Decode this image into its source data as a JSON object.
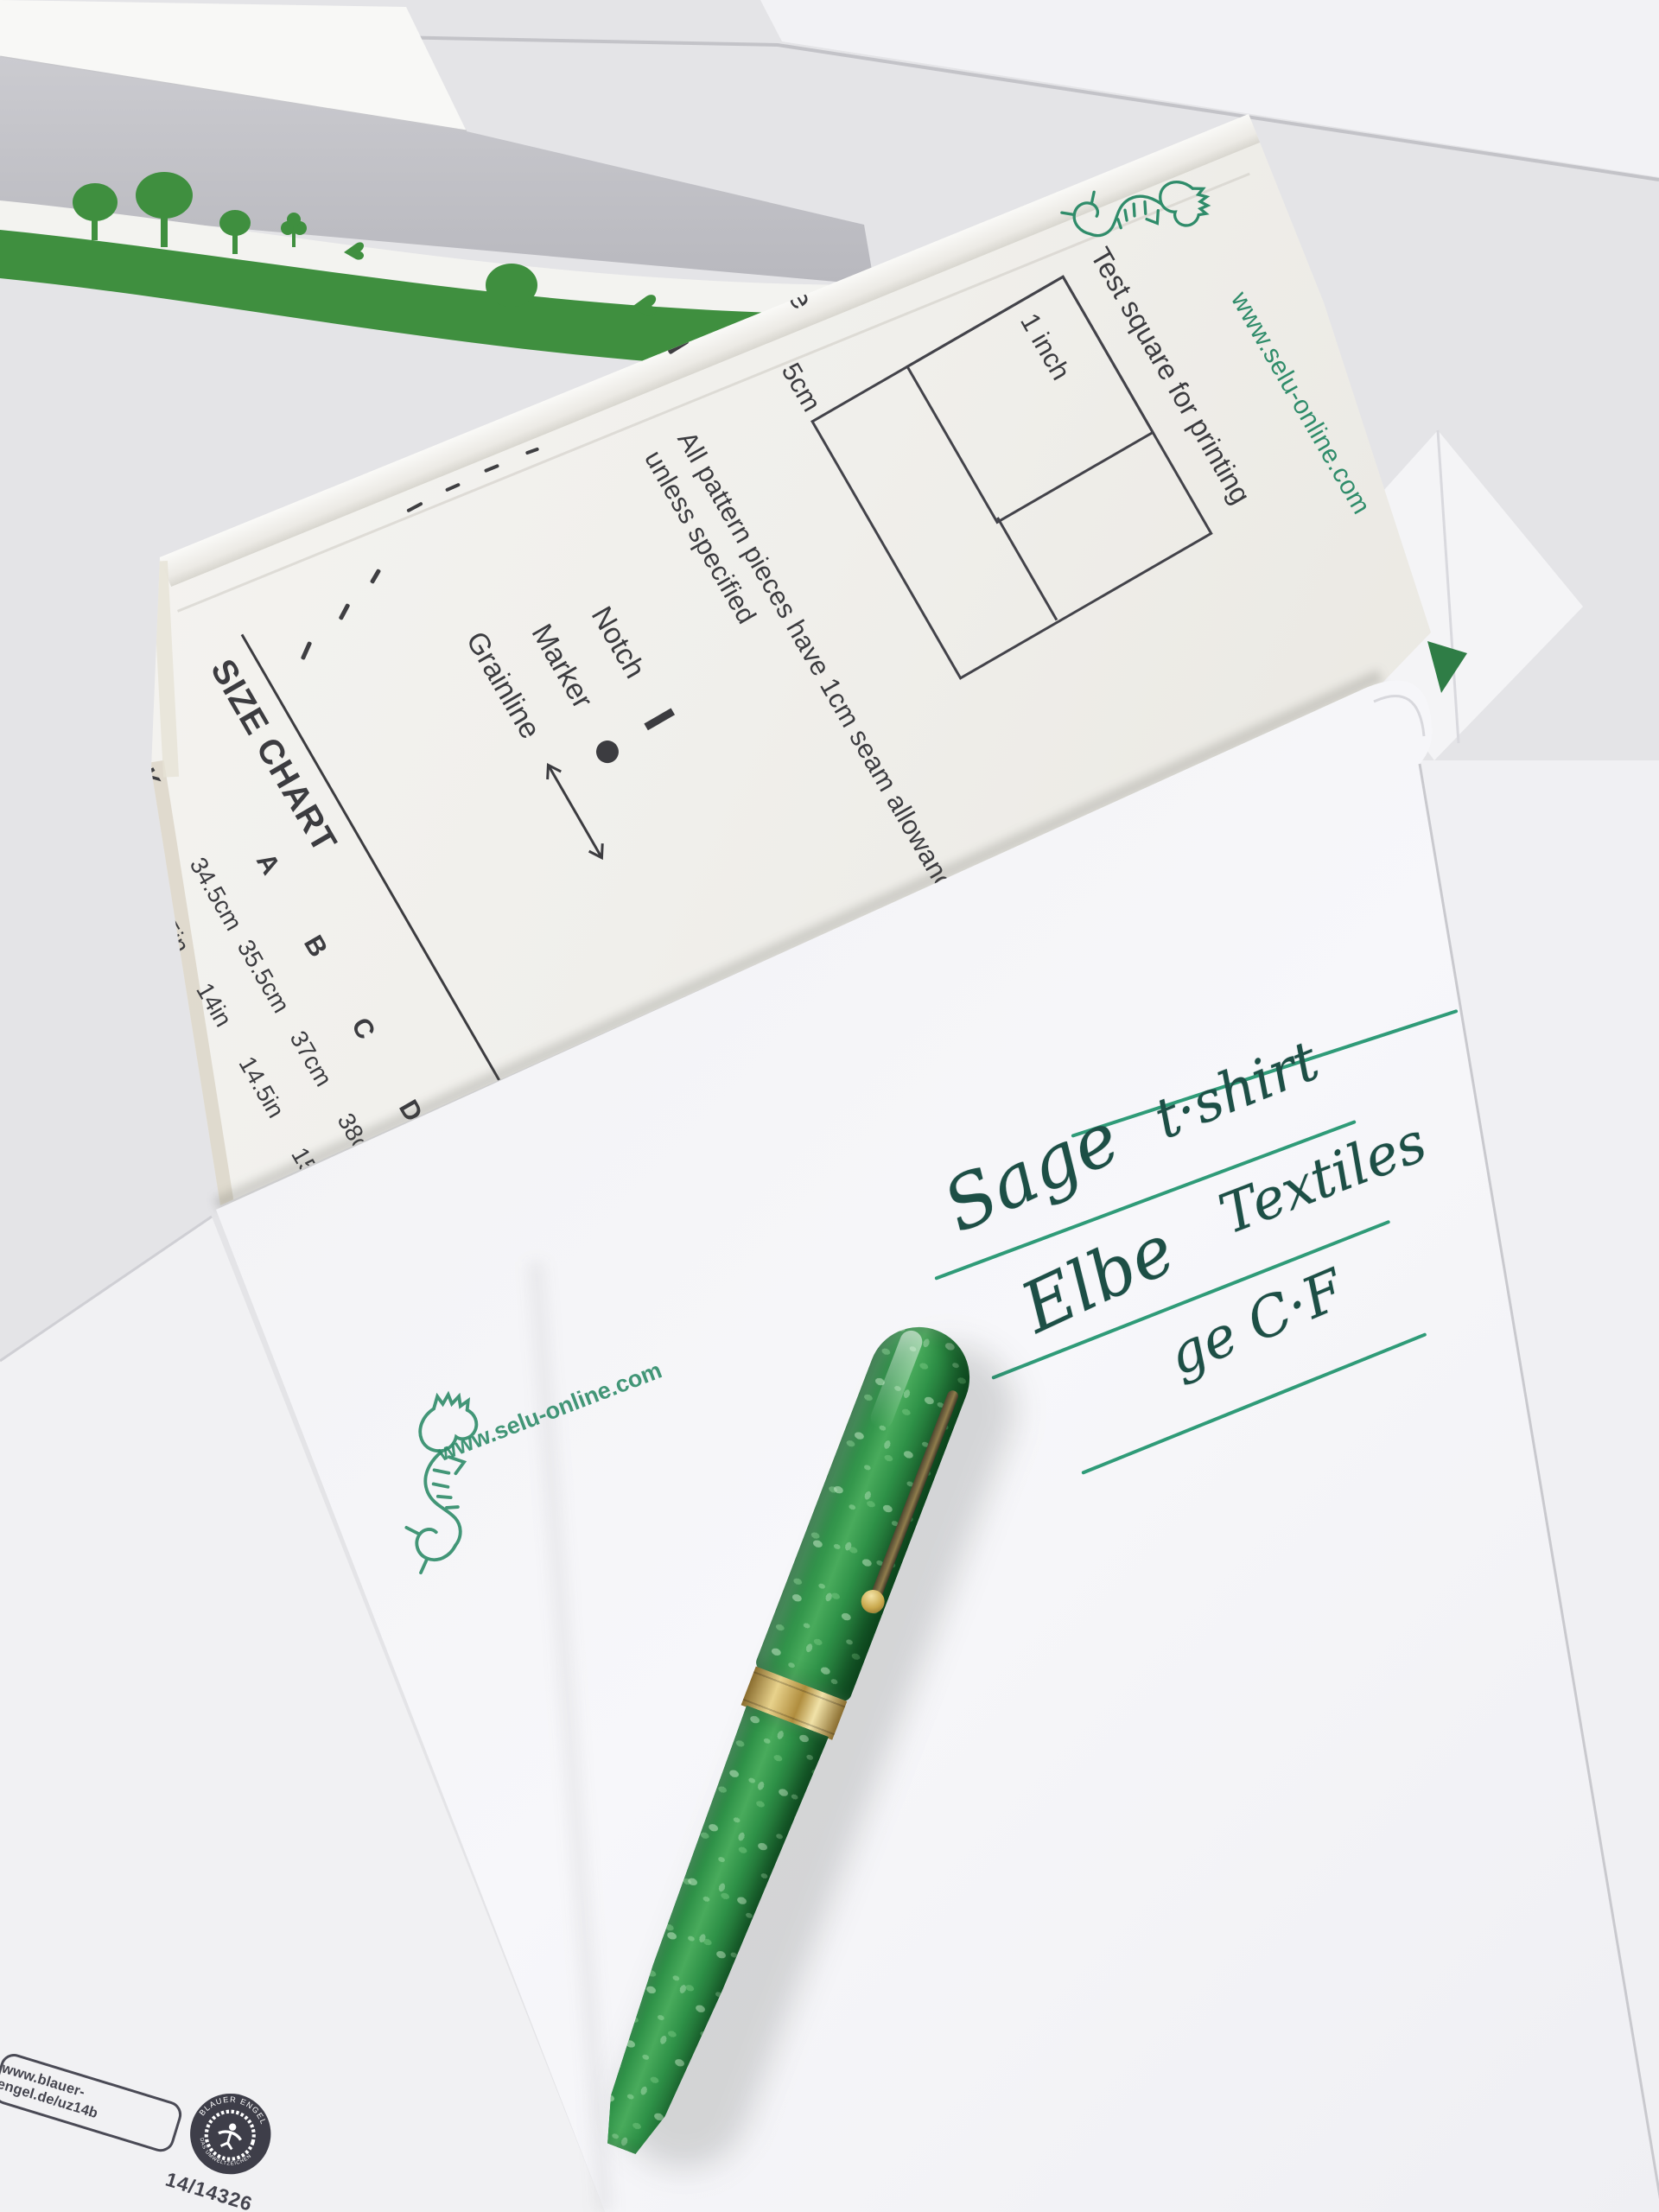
{
  "pattern_sheet": {
    "website": "www.selu-online.com",
    "test_square": {
      "caption": "Test square for printing",
      "inner_label": "1 inch",
      "outer_label": "5cm"
    },
    "seam_note_line1": "All pattern pieces have 1cm seam allowance",
    "seam_note_line2": "unless specified",
    "legend": {
      "notch": "Notch",
      "marker": "Marker",
      "grainline": "Grainline"
    },
    "size_chart": {
      "title": "SIZE CHART",
      "row_label": "NECK",
      "columns": [
        "A",
        "B",
        "C",
        "D",
        "E"
      ],
      "neck_cm": [
        "34.5cm",
        "35.5cm",
        "37cm",
        "38cm",
        "39.5cm"
      ],
      "neck_in": [
        "13.5in",
        "14in",
        "14.5in",
        "15in",
        "15.5in"
      ]
    },
    "edge_fragment": "ude"
  },
  "envelope": {
    "stamp_website": "www.selu-online.com",
    "handwriting": {
      "line1_word1": "Sage",
      "line1_word2": "t·shirt",
      "line2_word1": "Elbe",
      "line2_word2": "Textiles",
      "line3": "ge C·F"
    }
  },
  "bottom_envelope": {
    "print_url": "www.blauer-engel.de/uz14b",
    "cert_number": "14/14326",
    "logo_arc_top": "BLAUER ENGEL",
    "logo_arc_bottom": "DAS UMWELTZEICHEN"
  },
  "colors": {
    "selu_green": "#2f8c6a",
    "ruled_line_green": "#2f9b78",
    "handwriting_ink": "#1d4f46",
    "eco_print_green": "#3f8f3f",
    "pen_body_green": "#2f9248",
    "pen_band_gold": "#c9a84c",
    "print_black": "#3c3c40",
    "blauer_engel_navy": "#3e3e49"
  }
}
